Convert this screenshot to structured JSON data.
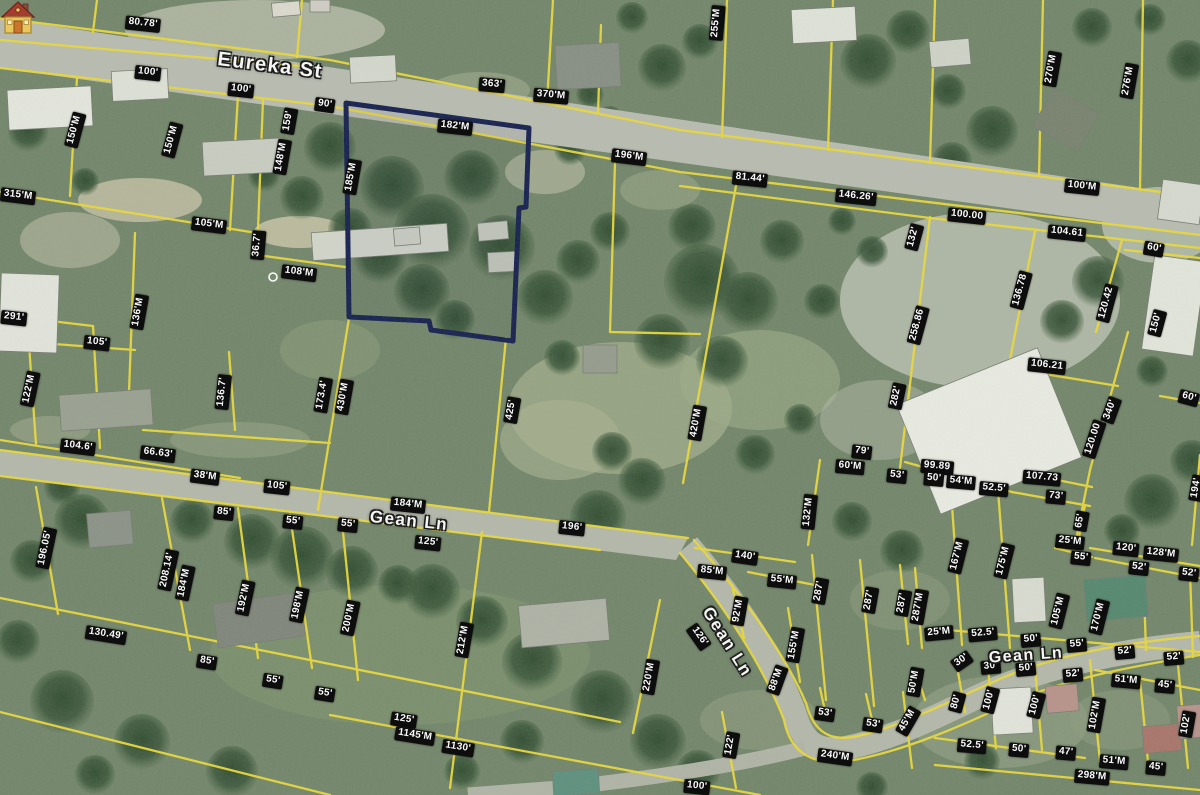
{
  "map": {
    "streets": [
      {
        "label": "Eureka St",
        "x": 270,
        "y": 66,
        "rotate": 7,
        "size": 20
      },
      {
        "label": "Gean Ln",
        "x": 409,
        "y": 521,
        "rotate": 6,
        "size": 17
      },
      {
        "label": "Gean Ln",
        "x": 727,
        "y": 642,
        "rotate": 58,
        "size": 17
      },
      {
        "label": "Gean Ln",
        "x": 1026,
        "y": 656,
        "rotate": -4,
        "size": 16
      }
    ],
    "subject_parcel": {
      "marker": "house-icon",
      "outline_color": "#16204f"
    },
    "colors": {
      "parcel_line": "#e9d83b",
      "road_fill": "#b8bbb0",
      "label_bg": "#0d0d0d",
      "label_text": "#fafafa"
    },
    "dimension_labels": [
      {
        "t": "80.78'",
        "x": 143,
        "y": 24,
        "r": 6
      },
      {
        "t": "100'",
        "x": 148,
        "y": 73,
        "r": 6
      },
      {
        "t": "100'",
        "x": 241,
        "y": 90,
        "r": 6
      },
      {
        "t": "90'",
        "x": 325,
        "y": 105,
        "r": 8
      },
      {
        "t": "363'",
        "x": 492,
        "y": 85,
        "r": 5
      },
      {
        "t": "370'M",
        "x": 551,
        "y": 96,
        "r": 5
      },
      {
        "t": "182'M",
        "x": 455,
        "y": 127,
        "r": 6
      },
      {
        "t": "196'M",
        "x": 629,
        "y": 157,
        "r": 7
      },
      {
        "t": "81.44'",
        "x": 750,
        "y": 179,
        "r": 6
      },
      {
        "t": "146.26'",
        "x": 856,
        "y": 197,
        "r": 6
      },
      {
        "t": "100'M",
        "x": 1082,
        "y": 187,
        "r": 6
      },
      {
        "t": "100.00",
        "x": 967,
        "y": 216,
        "r": 6
      },
      {
        "t": "104.61",
        "x": 1067,
        "y": 233,
        "r": 6
      },
      {
        "t": "60'",
        "x": 1154,
        "y": 249,
        "r": 10
      },
      {
        "t": "255'M",
        "x": 717,
        "y": 23,
        "r": -85
      },
      {
        "t": "270'M",
        "x": 1052,
        "y": 69,
        "r": -80
      },
      {
        "t": "276'M",
        "x": 1129,
        "y": 81,
        "r": -80
      },
      {
        "t": "150'M",
        "x": 75,
        "y": 130,
        "r": -75
      },
      {
        "t": "150'M",
        "x": 172,
        "y": 140,
        "r": -75
      },
      {
        "t": "159'",
        "x": 289,
        "y": 121,
        "r": -80
      },
      {
        "t": "148'M",
        "x": 282,
        "y": 157,
        "r": -80
      },
      {
        "t": "185'M",
        "x": 352,
        "y": 177,
        "r": -80
      },
      {
        "t": "315'M",
        "x": 18,
        "y": 196,
        "r": 7
      },
      {
        "t": "105'M",
        "x": 209,
        "y": 225,
        "r": 7
      },
      {
        "t": "36.7'",
        "x": 258,
        "y": 245,
        "r": -85
      },
      {
        "t": "108'M",
        "x": 299,
        "y": 273,
        "r": 7
      },
      {
        "t": "291'",
        "x": 14,
        "y": 318,
        "r": 6
      },
      {
        "t": "136'M",
        "x": 139,
        "y": 312,
        "r": -80
      },
      {
        "t": "105'",
        "x": 97,
        "y": 343,
        "r": 6
      },
      {
        "t": "122'M",
        "x": 30,
        "y": 389,
        "r": -78
      },
      {
        "t": "136.7'",
        "x": 223,
        "y": 392,
        "r": -84
      },
      {
        "t": "173.4'",
        "x": 323,
        "y": 395,
        "r": -80
      },
      {
        "t": "430'M",
        "x": 344,
        "y": 397,
        "r": -80
      },
      {
        "t": "425'",
        "x": 512,
        "y": 410,
        "r": -80
      },
      {
        "t": "420'M",
        "x": 697,
        "y": 423,
        "r": -80
      },
      {
        "t": "282'",
        "x": 897,
        "y": 396,
        "r": -78
      },
      {
        "t": "132'",
        "x": 914,
        "y": 237,
        "r": -75
      },
      {
        "t": "258.86",
        "x": 918,
        "y": 325,
        "r": -75
      },
      {
        "t": "136.78",
        "x": 1021,
        "y": 290,
        "r": -75
      },
      {
        "t": "120.42",
        "x": 1107,
        "y": 303,
        "r": -75
      },
      {
        "t": "150'",
        "x": 1157,
        "y": 323,
        "r": -75
      },
      {
        "t": "106.21",
        "x": 1047,
        "y": 366,
        "r": 6
      },
      {
        "t": "340'",
        "x": 1111,
        "y": 410,
        "r": -70
      },
      {
        "t": "60'",
        "x": 1189,
        "y": 398,
        "r": 15
      },
      {
        "t": "120.00",
        "x": 1094,
        "y": 439,
        "r": -72
      },
      {
        "t": "79'",
        "x": 862,
        "y": 452,
        "r": 6
      },
      {
        "t": "60'M",
        "x": 850,
        "y": 467,
        "r": 5
      },
      {
        "t": "53'",
        "x": 897,
        "y": 476,
        "r": 6
      },
      {
        "t": "99.89",
        "x": 937,
        "y": 467,
        "r": 5
      },
      {
        "t": "50'",
        "x": 934,
        "y": 479,
        "r": 5
      },
      {
        "t": "54'M",
        "x": 961,
        "y": 482,
        "r": 5
      },
      {
        "t": "52.5'",
        "x": 994,
        "y": 489,
        "r": 5
      },
      {
        "t": "107.73",
        "x": 1042,
        "y": 478,
        "r": 5
      },
      {
        "t": "73'",
        "x": 1056,
        "y": 497,
        "r": 5
      },
      {
        "t": "65'",
        "x": 1081,
        "y": 521,
        "r": -80
      },
      {
        "t": "25'M",
        "x": 1070,
        "y": 542,
        "r": 6
      },
      {
        "t": "55'",
        "x": 1081,
        "y": 558,
        "r": 6
      },
      {
        "t": "120'",
        "x": 1126,
        "y": 549,
        "r": 6
      },
      {
        "t": "128'M",
        "x": 1161,
        "y": 554,
        "r": 6
      },
      {
        "t": "52'",
        "x": 1139,
        "y": 568,
        "r": 6
      },
      {
        "t": "52'",
        "x": 1189,
        "y": 574,
        "r": 6
      },
      {
        "t": "194'",
        "x": 1197,
        "y": 488,
        "r": -80
      },
      {
        "t": "167'M",
        "x": 958,
        "y": 556,
        "r": -76
      },
      {
        "t": "175'M",
        "x": 1004,
        "y": 561,
        "r": -76
      },
      {
        "t": "104.6'",
        "x": 78,
        "y": 447,
        "r": 7
      },
      {
        "t": "66.63'",
        "x": 158,
        "y": 454,
        "r": 7
      },
      {
        "t": "38'M",
        "x": 205,
        "y": 477,
        "r": 7
      },
      {
        "t": "105'",
        "x": 277,
        "y": 487,
        "r": 6
      },
      {
        "t": "85'",
        "x": 224,
        "y": 513,
        "r": 6
      },
      {
        "t": "55'",
        "x": 293,
        "y": 522,
        "r": 6
      },
      {
        "t": "55'",
        "x": 348,
        "y": 525,
        "r": 6
      },
      {
        "t": "196.05'",
        "x": 46,
        "y": 548,
        "r": -78
      },
      {
        "t": "208.14'",
        "x": 168,
        "y": 570,
        "r": -78
      },
      {
        "t": "184'M",
        "x": 185,
        "y": 583,
        "r": -78
      },
      {
        "t": "192'M",
        "x": 245,
        "y": 598,
        "r": -78
      },
      {
        "t": "198'M",
        "x": 299,
        "y": 605,
        "r": -78
      },
      {
        "t": "200'M",
        "x": 350,
        "y": 618,
        "r": -78
      },
      {
        "t": "130.49'",
        "x": 106,
        "y": 635,
        "r": 9
      },
      {
        "t": "85'",
        "x": 207,
        "y": 662,
        "r": 9
      },
      {
        "t": "55'",
        "x": 273,
        "y": 681,
        "r": 9
      },
      {
        "t": "55'",
        "x": 325,
        "y": 694,
        "r": 9
      },
      {
        "t": "184'M",
        "x": 408,
        "y": 505,
        "r": 6
      },
      {
        "t": "125'",
        "x": 428,
        "y": 543,
        "r": 6
      },
      {
        "t": "196'",
        "x": 572,
        "y": 528,
        "r": 6
      },
      {
        "t": "212'M",
        "x": 464,
        "y": 640,
        "r": -80
      },
      {
        "t": "125'",
        "x": 404,
        "y": 720,
        "r": 9
      },
      {
        "t": "1145'M",
        "x": 415,
        "y": 736,
        "r": 9
      },
      {
        "t": "1130'",
        "x": 458,
        "y": 748,
        "r": 9
      },
      {
        "t": "220'M",
        "x": 650,
        "y": 677,
        "r": -80
      },
      {
        "t": "100'",
        "x": 697,
        "y": 787,
        "r": 6
      },
      {
        "t": "140'",
        "x": 745,
        "y": 557,
        "r": 8
      },
      {
        "t": "85'M",
        "x": 712,
        "y": 572,
        "r": 6
      },
      {
        "t": "55'M",
        "x": 782,
        "y": 581,
        "r": 6
      },
      {
        "t": "92'M",
        "x": 739,
        "y": 611,
        "r": -80
      },
      {
        "t": "126'",
        "x": 699,
        "y": 637,
        "r": 55
      },
      {
        "t": "155'M",
        "x": 795,
        "y": 645,
        "r": -80
      },
      {
        "t": "88'M",
        "x": 777,
        "y": 680,
        "r": -70
      },
      {
        "t": "132'M",
        "x": 809,
        "y": 512,
        "r": -84
      },
      {
        "t": "287'",
        "x": 820,
        "y": 591,
        "r": -80
      },
      {
        "t": "287'",
        "x": 870,
        "y": 600,
        "r": -80
      },
      {
        "t": "287'",
        "x": 903,
        "y": 603,
        "r": -80
      },
      {
        "t": "287'M",
        "x": 919,
        "y": 607,
        "r": -80
      },
      {
        "t": "53'",
        "x": 825,
        "y": 714,
        "r": 8
      },
      {
        "t": "53'",
        "x": 873,
        "y": 725,
        "r": 8
      },
      {
        "t": "45'M",
        "x": 908,
        "y": 721,
        "r": -60
      },
      {
        "t": "240'M",
        "x": 835,
        "y": 757,
        "r": 8
      },
      {
        "t": "122'",
        "x": 731,
        "y": 745,
        "r": -80
      },
      {
        "t": "50'M",
        "x": 915,
        "y": 682,
        "r": -80
      },
      {
        "t": "25'M",
        "x": 939,
        "y": 633,
        "r": -5
      },
      {
        "t": "52.5'",
        "x": 983,
        "y": 634,
        "r": -5
      },
      {
        "t": "50'",
        "x": 1031,
        "y": 640,
        "r": -5
      },
      {
        "t": "55'",
        "x": 1077,
        "y": 645,
        "r": -5
      },
      {
        "t": "52'",
        "x": 1125,
        "y": 652,
        "r": -5
      },
      {
        "t": "52'",
        "x": 1174,
        "y": 658,
        "r": -5
      },
      {
        "t": "105'M",
        "x": 1059,
        "y": 611,
        "r": -76
      },
      {
        "t": "170'M",
        "x": 1099,
        "y": 617,
        "r": -76
      },
      {
        "t": "30'",
        "x": 962,
        "y": 661,
        "r": -35
      },
      {
        "t": "30'",
        "x": 991,
        "y": 667,
        "r": -5
      },
      {
        "t": "50'",
        "x": 1026,
        "y": 669,
        "r": -5
      },
      {
        "t": "52'",
        "x": 1073,
        "y": 675,
        "r": -5
      },
      {
        "t": "51'M",
        "x": 1126,
        "y": 681,
        "r": 5
      },
      {
        "t": "45'",
        "x": 1165,
        "y": 686,
        "r": 5
      },
      {
        "t": "80'",
        "x": 957,
        "y": 702,
        "r": -75
      },
      {
        "t": "100'",
        "x": 990,
        "y": 700,
        "r": -75
      },
      {
        "t": "100'",
        "x": 1036,
        "y": 705,
        "r": -75
      },
      {
        "t": "102'M",
        "x": 1096,
        "y": 715,
        "r": -80
      },
      {
        "t": "102'",
        "x": 1187,
        "y": 724,
        "r": -80
      },
      {
        "t": "52.5'",
        "x": 972,
        "y": 746,
        "r": 5
      },
      {
        "t": "50'",
        "x": 1019,
        "y": 750,
        "r": 5
      },
      {
        "t": "47'",
        "x": 1066,
        "y": 753,
        "r": 5
      },
      {
        "t": "51'M",
        "x": 1114,
        "y": 762,
        "r": 5
      },
      {
        "t": "45'",
        "x": 1156,
        "y": 768,
        "r": 5
      },
      {
        "t": "298'M",
        "x": 1092,
        "y": 777,
        "r": 5
      }
    ]
  }
}
